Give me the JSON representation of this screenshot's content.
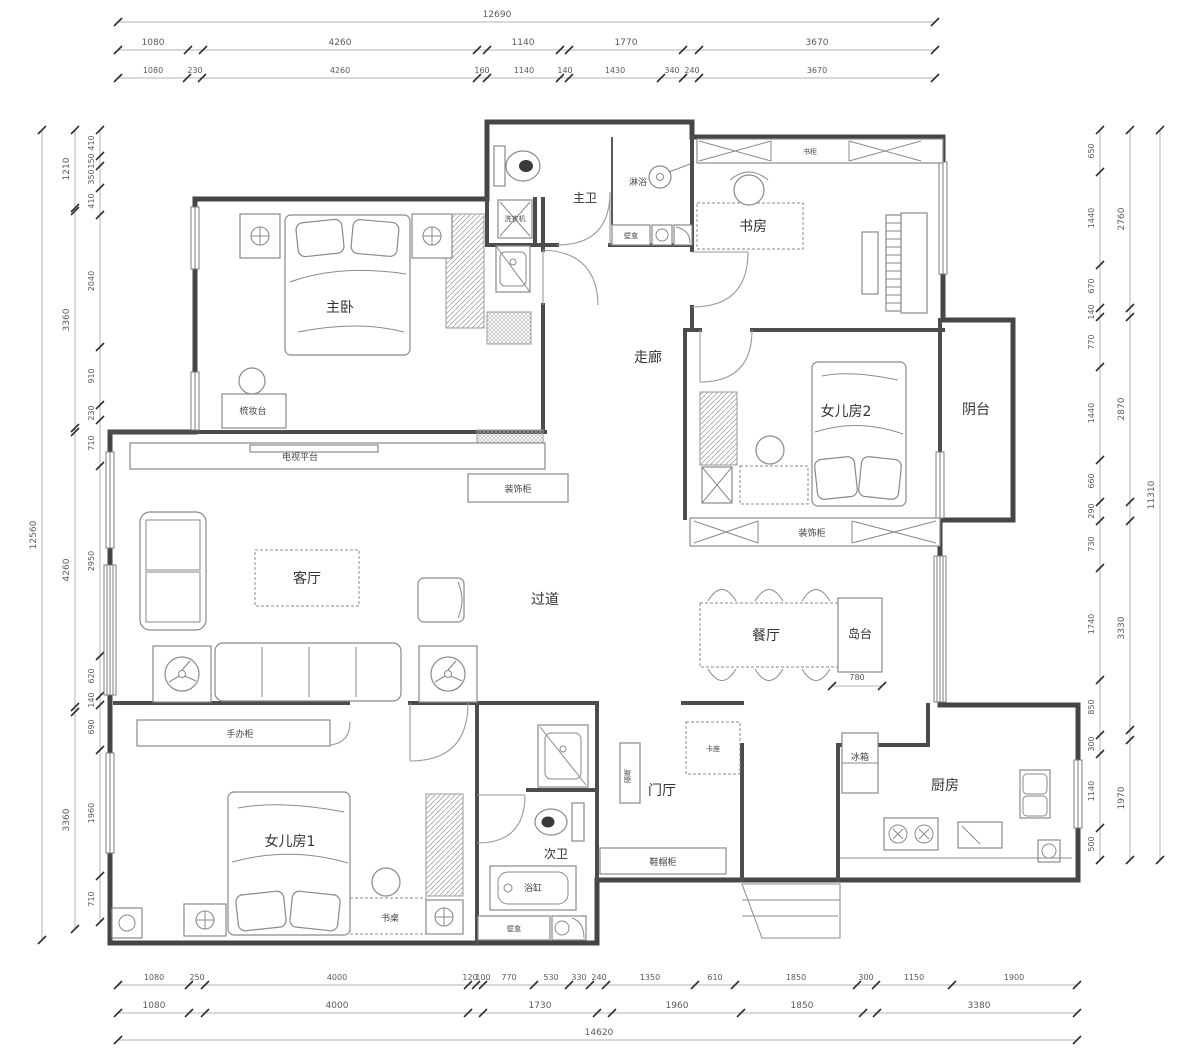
{
  "dims": {
    "top": {
      "total": "12690",
      "row2": [
        "1080",
        "4260",
        "1140",
        "1770",
        "3670"
      ],
      "row3": [
        "1080",
        "230",
        "4260",
        "160",
        "1140",
        "140",
        "1430",
        "340",
        "240",
        "3670"
      ]
    },
    "bottom": {
      "row1": [
        "1080",
        "250",
        "4000",
        "120",
        "100",
        "770",
        "530",
        "330",
        "240",
        "1350",
        "610",
        "1850",
        "300",
        "1150",
        "1900"
      ],
      "row2": [
        "1080",
        "4000",
        "1730",
        "1960",
        "1850",
        "3380"
      ],
      "total": "14620"
    },
    "left": {
      "total": "12560",
      "mid": [
        "1210",
        "3360",
        "4260",
        "3360"
      ],
      "inner": [
        "410",
        "150",
        "350",
        "410",
        "2040",
        "910",
        "230",
        "710",
        "2950",
        "620",
        "140",
        "690",
        "1960",
        "710"
      ]
    },
    "right": {
      "total": "11310",
      "mid": [
        "2760",
        "2870",
        "3330",
        "1970"
      ],
      "inner": [
        "650",
        "1440",
        "670",
        "140",
        "770",
        "1440",
        "660",
        "290",
        "730",
        "1740",
        "850",
        "300",
        "1140",
        "500"
      ]
    },
    "island_width": "780"
  },
  "labels": {
    "master_bedroom": "主卧",
    "dresser": "梳妆台",
    "master_bath": "主卫",
    "shower": "淋浴",
    "niche": "壁龛",
    "washing_machine": "洗衣机",
    "study": "书房",
    "bookcase": "书柜",
    "corridor": "走廊",
    "daughter_room2": "女儿房2",
    "balcony": "阴台",
    "deco_cabinet": "装饰柜",
    "tv_platform": "电视平台",
    "living_room": "客厅",
    "passage": "过道",
    "dining": "餐厅",
    "island": "岛台",
    "fridge": "冰箱",
    "kitchen": "厨房",
    "foyer": "门厅",
    "shoe_cabinet": "鞋帽柜",
    "booth": "卡座",
    "partition": "隔断",
    "second_bath": "次卫",
    "bathtub": "浴缸",
    "daughter_room1": "女儿房1",
    "desk": "书桌",
    "figure_cabinet": "手办柜"
  }
}
